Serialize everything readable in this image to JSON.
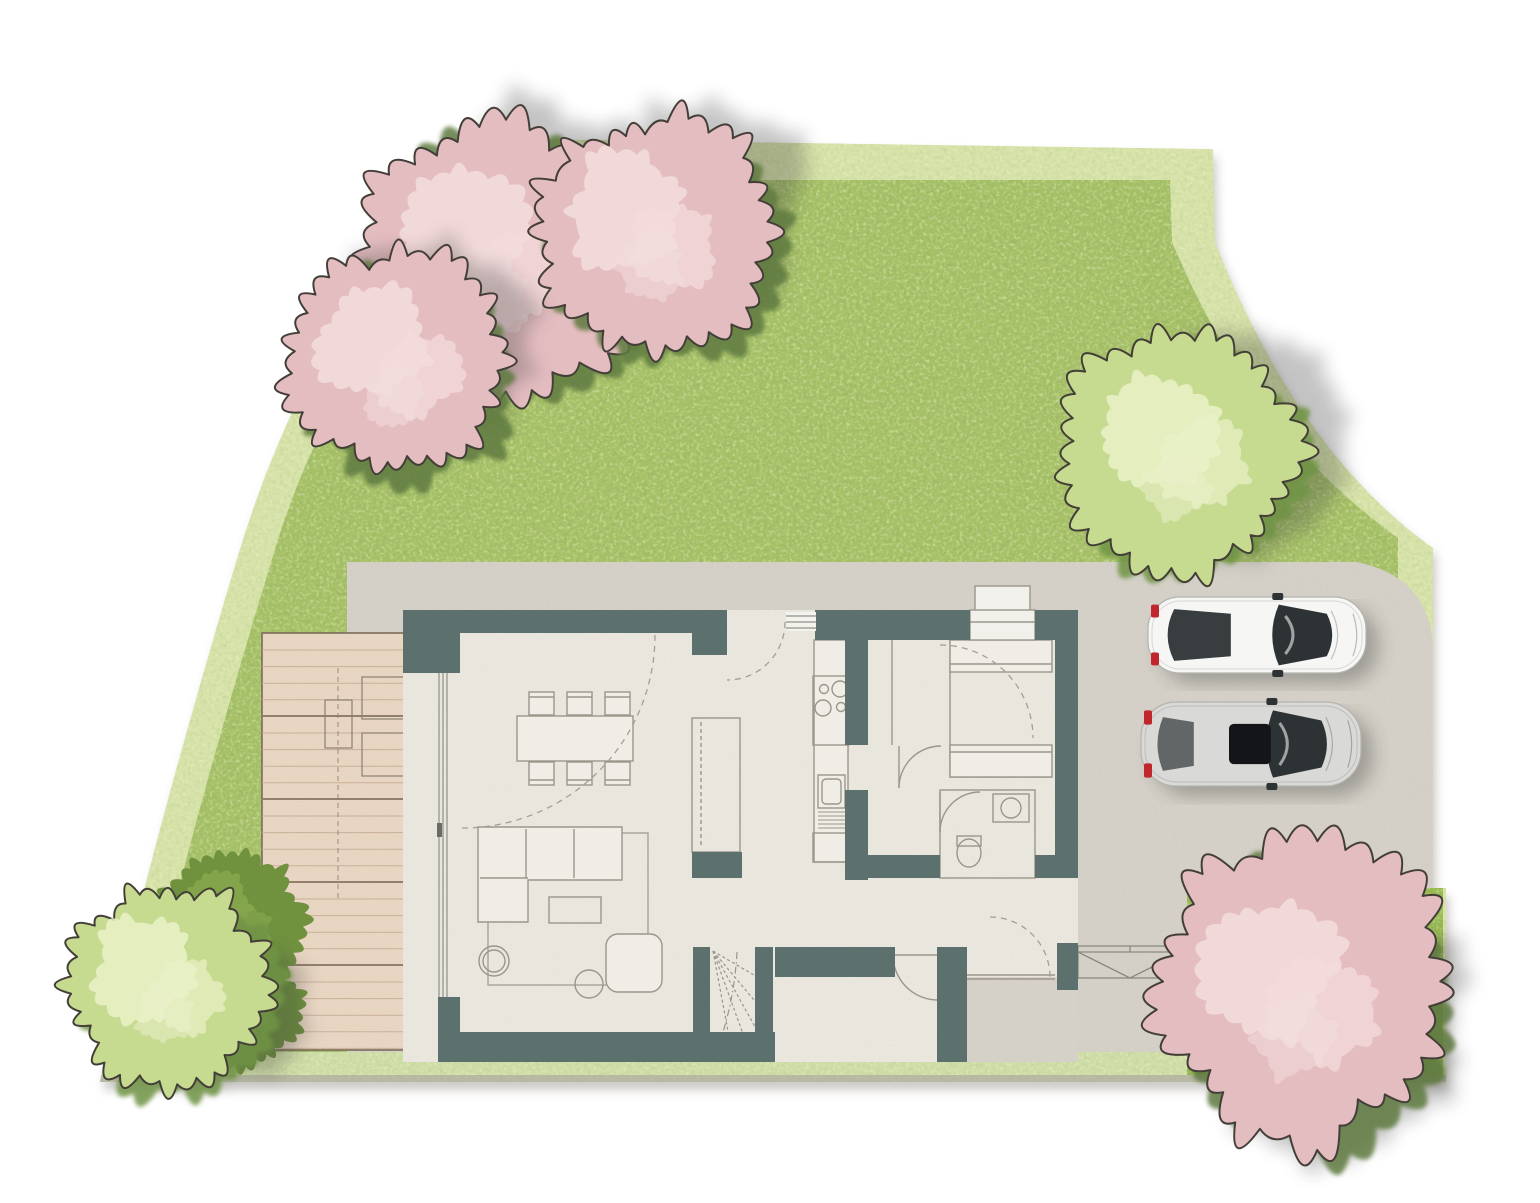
{
  "scene": {
    "description": "top-down watercolor site plan of a single family house with garden lawn, wooden deck, concrete driveway and two parked cars",
    "view": "top-down",
    "visible_text": []
  },
  "palette": {
    "background": "#ffffff",
    "wall_slate": "#5c706d",
    "floor": "#eae7df",
    "concrete": "#d5d1c8",
    "lawn": "#a6c167",
    "border_green": "#d7e3aa",
    "strip_green": "#cfdda9",
    "hedge_green": "#96ba50",
    "bush_green": "#70923f",
    "deck_wood": "#e9d6c3",
    "deck_line": "#c9b097",
    "deck_seam": "#93806a",
    "furniture_line": "#9b968b",
    "outline_dark": "#433e38",
    "blossom_pink": "#e4bdc1",
    "blossom_light": "#f3dddd",
    "tree_green": "#c6da90",
    "tree_green_light": "#e9f1c8",
    "clump_green": "#5e7a40",
    "car_white": "#f6f6f4",
    "car_silver": "#d9dad7",
    "taillight_red": "#c0272d",
    "glass_dark": "#2d3234"
  },
  "inventory": {
    "parked_cars": 2,
    "blossom_trees": 4,
    "green_trees": 2,
    "bushes": 2,
    "dining_chairs": 6,
    "deck_loungers": 2,
    "stove_burners": 4
  },
  "trees": [
    {
      "id": "bush-bottom-left-upper",
      "type": "bush",
      "cx": 232,
      "cy": 920,
      "r": 68,
      "seed": 41,
      "shadow": {
        "dx": 0,
        "dy": 0
      }
    },
    {
      "id": "bush-bottom-left-lower",
      "type": "bush",
      "cx": 240,
      "cy": 1005,
      "r": 58,
      "seed": 42,
      "shadow": {
        "dx": 0,
        "dy": 0
      }
    },
    {
      "id": "blossom-top-left-a",
      "type": "blossom",
      "cx": 492,
      "cy": 258,
      "r": 132,
      "seed": 1,
      "shadow": {
        "dx": 42,
        "dy": -30
      }
    },
    {
      "id": "blossom-top-left-b",
      "type": "blossom",
      "cx": 655,
      "cy": 232,
      "r": 112,
      "seed": 2,
      "shadow": {
        "dx": 42,
        "dy": -28
      }
    },
    {
      "id": "blossom-top-left-c",
      "type": "blossom",
      "cx": 398,
      "cy": 362,
      "r": 104,
      "seed": 3,
      "shadow": {
        "dx": 36,
        "dy": -20
      }
    },
    {
      "id": "green-tree-top-right",
      "type": "green",
      "cx": 1183,
      "cy": 452,
      "r": 112,
      "seed": 4,
      "shadow": {
        "dx": 58,
        "dy": -4
      }
    },
    {
      "id": "green-tree-bottom-left",
      "type": "green",
      "cx": 168,
      "cy": 985,
      "r": 95,
      "seed": 5,
      "shadow": {
        "dx": 40,
        "dy": 16
      }
    },
    {
      "id": "blossom-bottom-right",
      "type": "blossom",
      "cx": 1302,
      "cy": 995,
      "r": 138,
      "seed": 6,
      "shadow": {
        "dx": 30,
        "dy": 26
      }
    }
  ],
  "cars": [
    {
      "id": "car-white",
      "body": "#f6f6f4",
      "x": 1148,
      "y": 597,
      "len": 218,
      "wid": 76,
      "sunroof": false,
      "rear_glass": true
    },
    {
      "id": "car-silver",
      "body": "#d9dad7",
      "x": 1141,
      "y": 702,
      "len": 220,
      "wid": 84,
      "sunroof": true,
      "rear_glass": false
    }
  ]
}
